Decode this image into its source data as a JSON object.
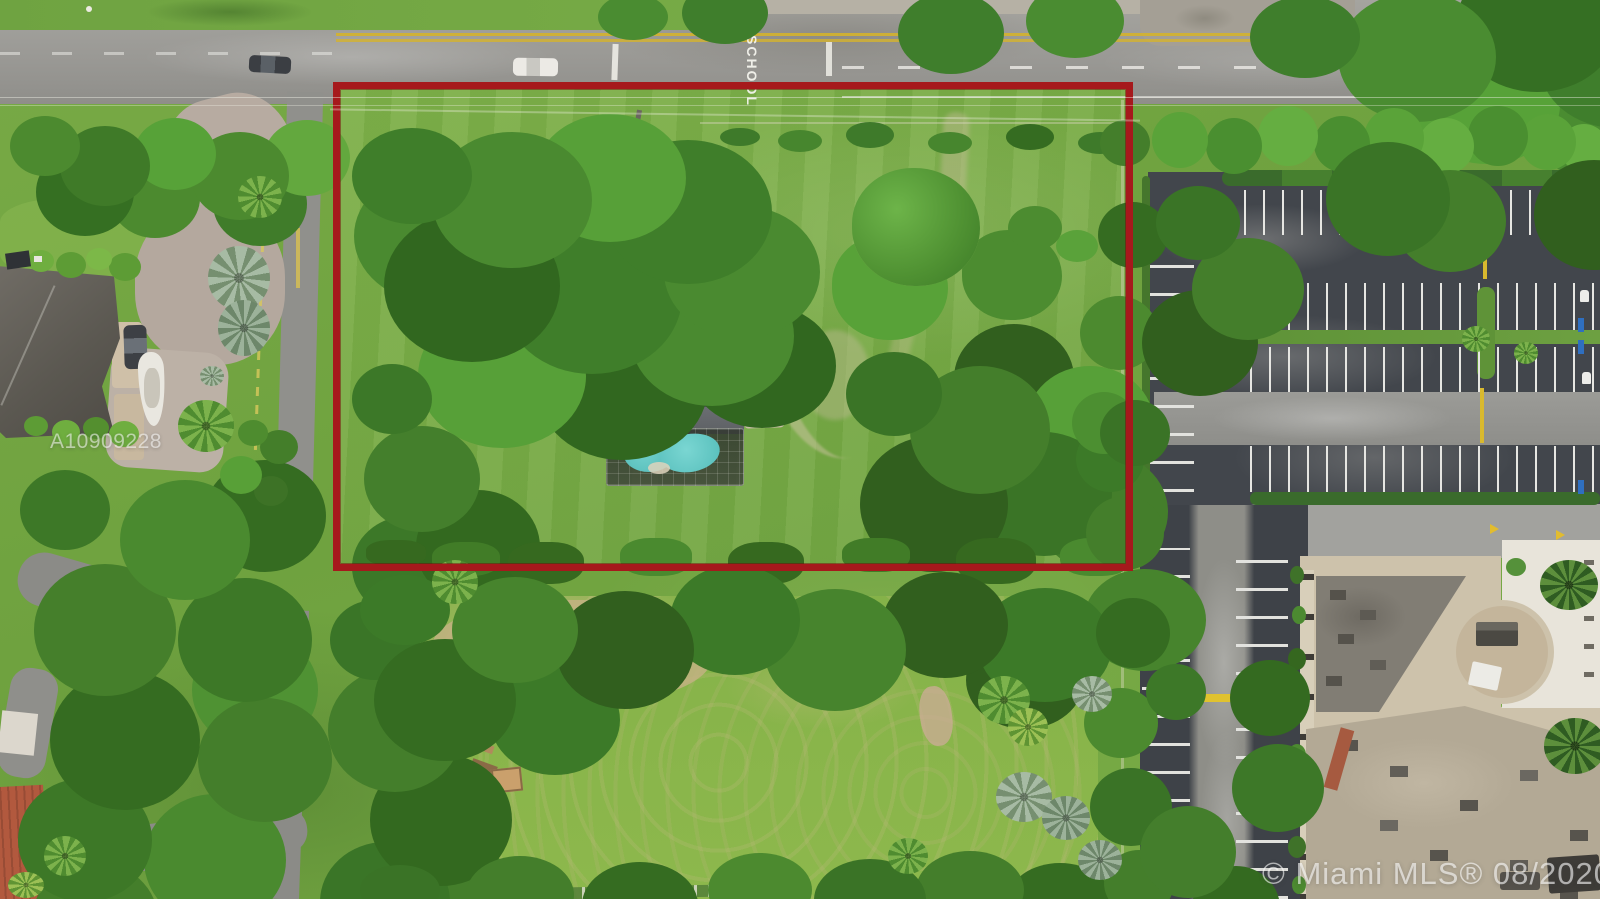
{
  "watermarks": {
    "listing_id": "A10909228",
    "mls_credit": "© Miami MLS® 08/2020"
  },
  "road": {
    "pavement_marking": "SCHOOL"
  },
  "annotations": {
    "property_boundary": {
      "shape": "rectangle",
      "color": "#A6191C",
      "description_source": "red outline drawn over aerial photo"
    }
  },
  "palette": {
    "grass": "#76A845",
    "road_asphalt": "#9A9995",
    "parking_asphalt": "#42464C",
    "house_roof": "#54575B",
    "pool_water": "#5BC8C4",
    "building_roof": "#CDC2AB",
    "driveway_paver": "#B7ABA1",
    "stripe_white": "#E6E6E2",
    "curb_yellow": "#D9B92E"
  }
}
